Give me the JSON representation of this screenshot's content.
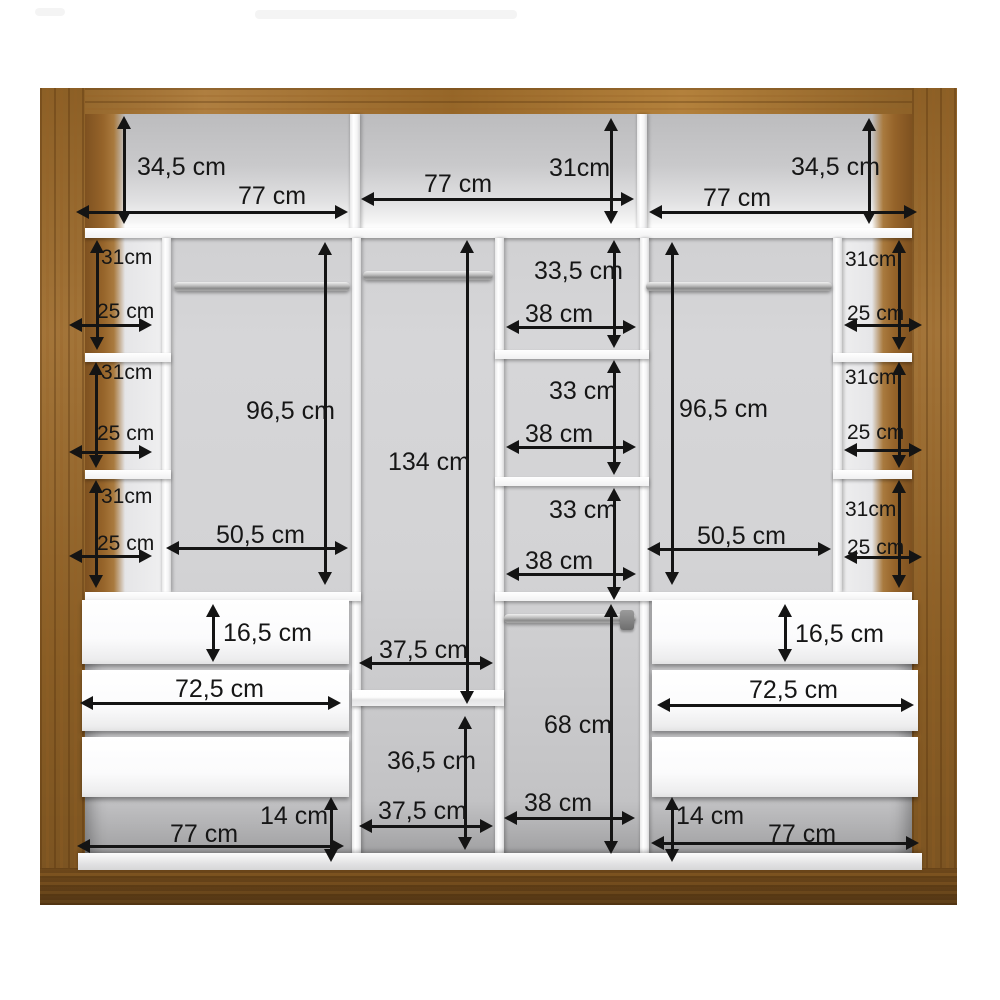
{
  "diagram": {
    "title": "Wardrobe interior dimension diagram",
    "unit": "cm",
    "colors": {
      "wood_frame": "#a7722d",
      "wood_dark": "#7d521f",
      "interior_gray": "#d2d2d4",
      "panel_white": "#ffffff",
      "dimension_lines": "#161616"
    },
    "top_shelves": {
      "left": {
        "width": "77 cm",
        "height": "34,5 cm"
      },
      "middle": {
        "width": "77 cm",
        "height": "31cm"
      },
      "right": {
        "width": "77 cm",
        "height": "34,5 cm"
      }
    },
    "left_side_cells": [
      {
        "height": "31cm",
        "depth": "25 cm"
      },
      {
        "height": "31cm",
        "depth": "25 cm"
      },
      {
        "height": "31cm",
        "depth": "25 cm"
      }
    ],
    "right_side_cells": [
      {
        "height": "31cm",
        "depth": "25 cm"
      },
      {
        "height": "31cm",
        "depth": "25 cm"
      },
      {
        "height": "31cm",
        "depth": "25 cm"
      }
    ],
    "left_hanging_section": {
      "height": "96,5 cm",
      "width": "50,5 cm"
    },
    "right_hanging_section": {
      "height": "96,5 cm",
      "width": "50,5 cm"
    },
    "middle_tall_section": {
      "height": "134 cm",
      "width": "37,5 cm"
    },
    "middle_shelf_cells": [
      {
        "height": "33,5 cm",
        "width": "38 cm"
      },
      {
        "height": "33 cm",
        "width": "38 cm"
      },
      {
        "height": "33 cm",
        "width": "38 cm"
      }
    ],
    "middle_bottom_cell": {
      "height": "36,5 cm",
      "width": "37,5 cm"
    },
    "bottom_hanging_cell": {
      "height": "68 cm",
      "width": "38 cm"
    },
    "left_drawer_unit": {
      "drawer_front_height": "16,5 cm",
      "width": "72,5 cm"
    },
    "right_drawer_unit": {
      "drawer_front_height": "16,5 cm",
      "width": "72,5 cm"
    },
    "bottom_left_clearance": {
      "height": "14 cm",
      "width": "77 cm"
    },
    "bottom_right_clearance": {
      "height": "14 cm",
      "width": "77 cm"
    }
  }
}
